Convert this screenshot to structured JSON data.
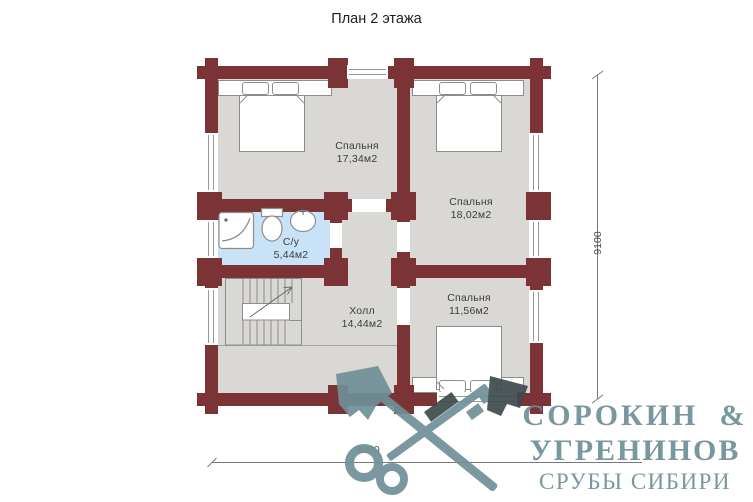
{
  "title": "План 2 этажа",
  "rooms": {
    "bedroom1": {
      "name": "Спальня",
      "area": "17,34м2"
    },
    "bedroom2": {
      "name": "Спальня",
      "area": "18,02м2"
    },
    "bedroom3": {
      "name": "Спальня",
      "area": "11,56м2"
    },
    "bathroom": {
      "name": "С/у",
      "area": "5,44м2"
    },
    "hall": {
      "name": "Холл",
      "area": "14,44м2"
    }
  },
  "dimensions": {
    "horizontal": "8900",
    "vertical": "9100"
  },
  "watermark": {
    "line1": "СОРОКИН  &",
    "line2": "УГРЕНИНОВ",
    "line3": "СРУБЫ СИБИРИ",
    "icon": "crossed-axe-and-key-icon"
  },
  "colors": {
    "wall": "#7B3336",
    "floor": "#D9D8D5",
    "bathroom_floor": "#C8E3F7",
    "watermark": "#6F9097",
    "watermark_dark": "#3E4A4E"
  }
}
